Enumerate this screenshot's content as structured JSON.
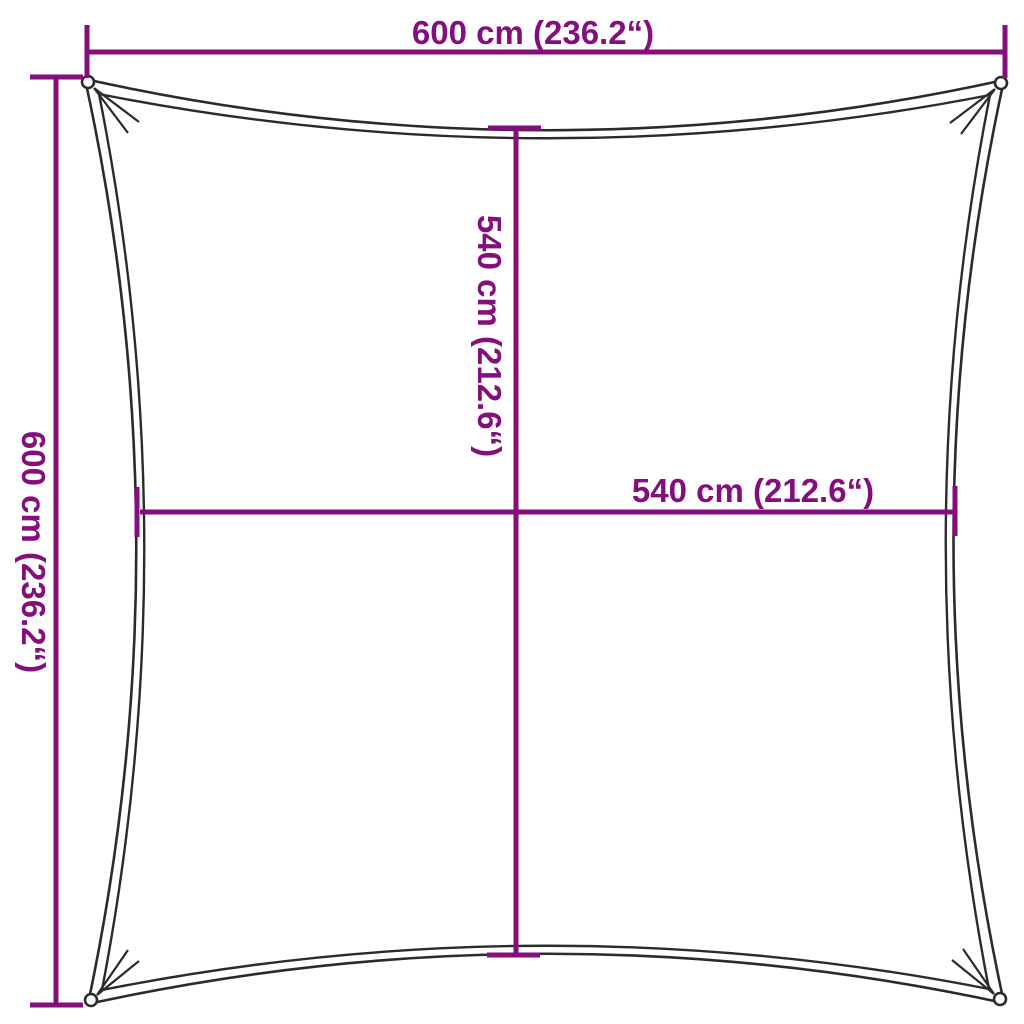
{
  "colors": {
    "background": "#ffffff",
    "dimension": "#850e7d",
    "outline": "#2b2b2b"
  },
  "figure": {
    "description": "Square shade sail with concave edges and corner grommets"
  },
  "dimensions": {
    "top": {
      "label": "600 cm (236.2“)"
    },
    "left": {
      "label": "600 cm (236.2“)"
    },
    "center_vertical": {
      "label": "540 cm (212.6“)"
    },
    "center_horizontal": {
      "label": "540 cm (212.6“)"
    }
  }
}
